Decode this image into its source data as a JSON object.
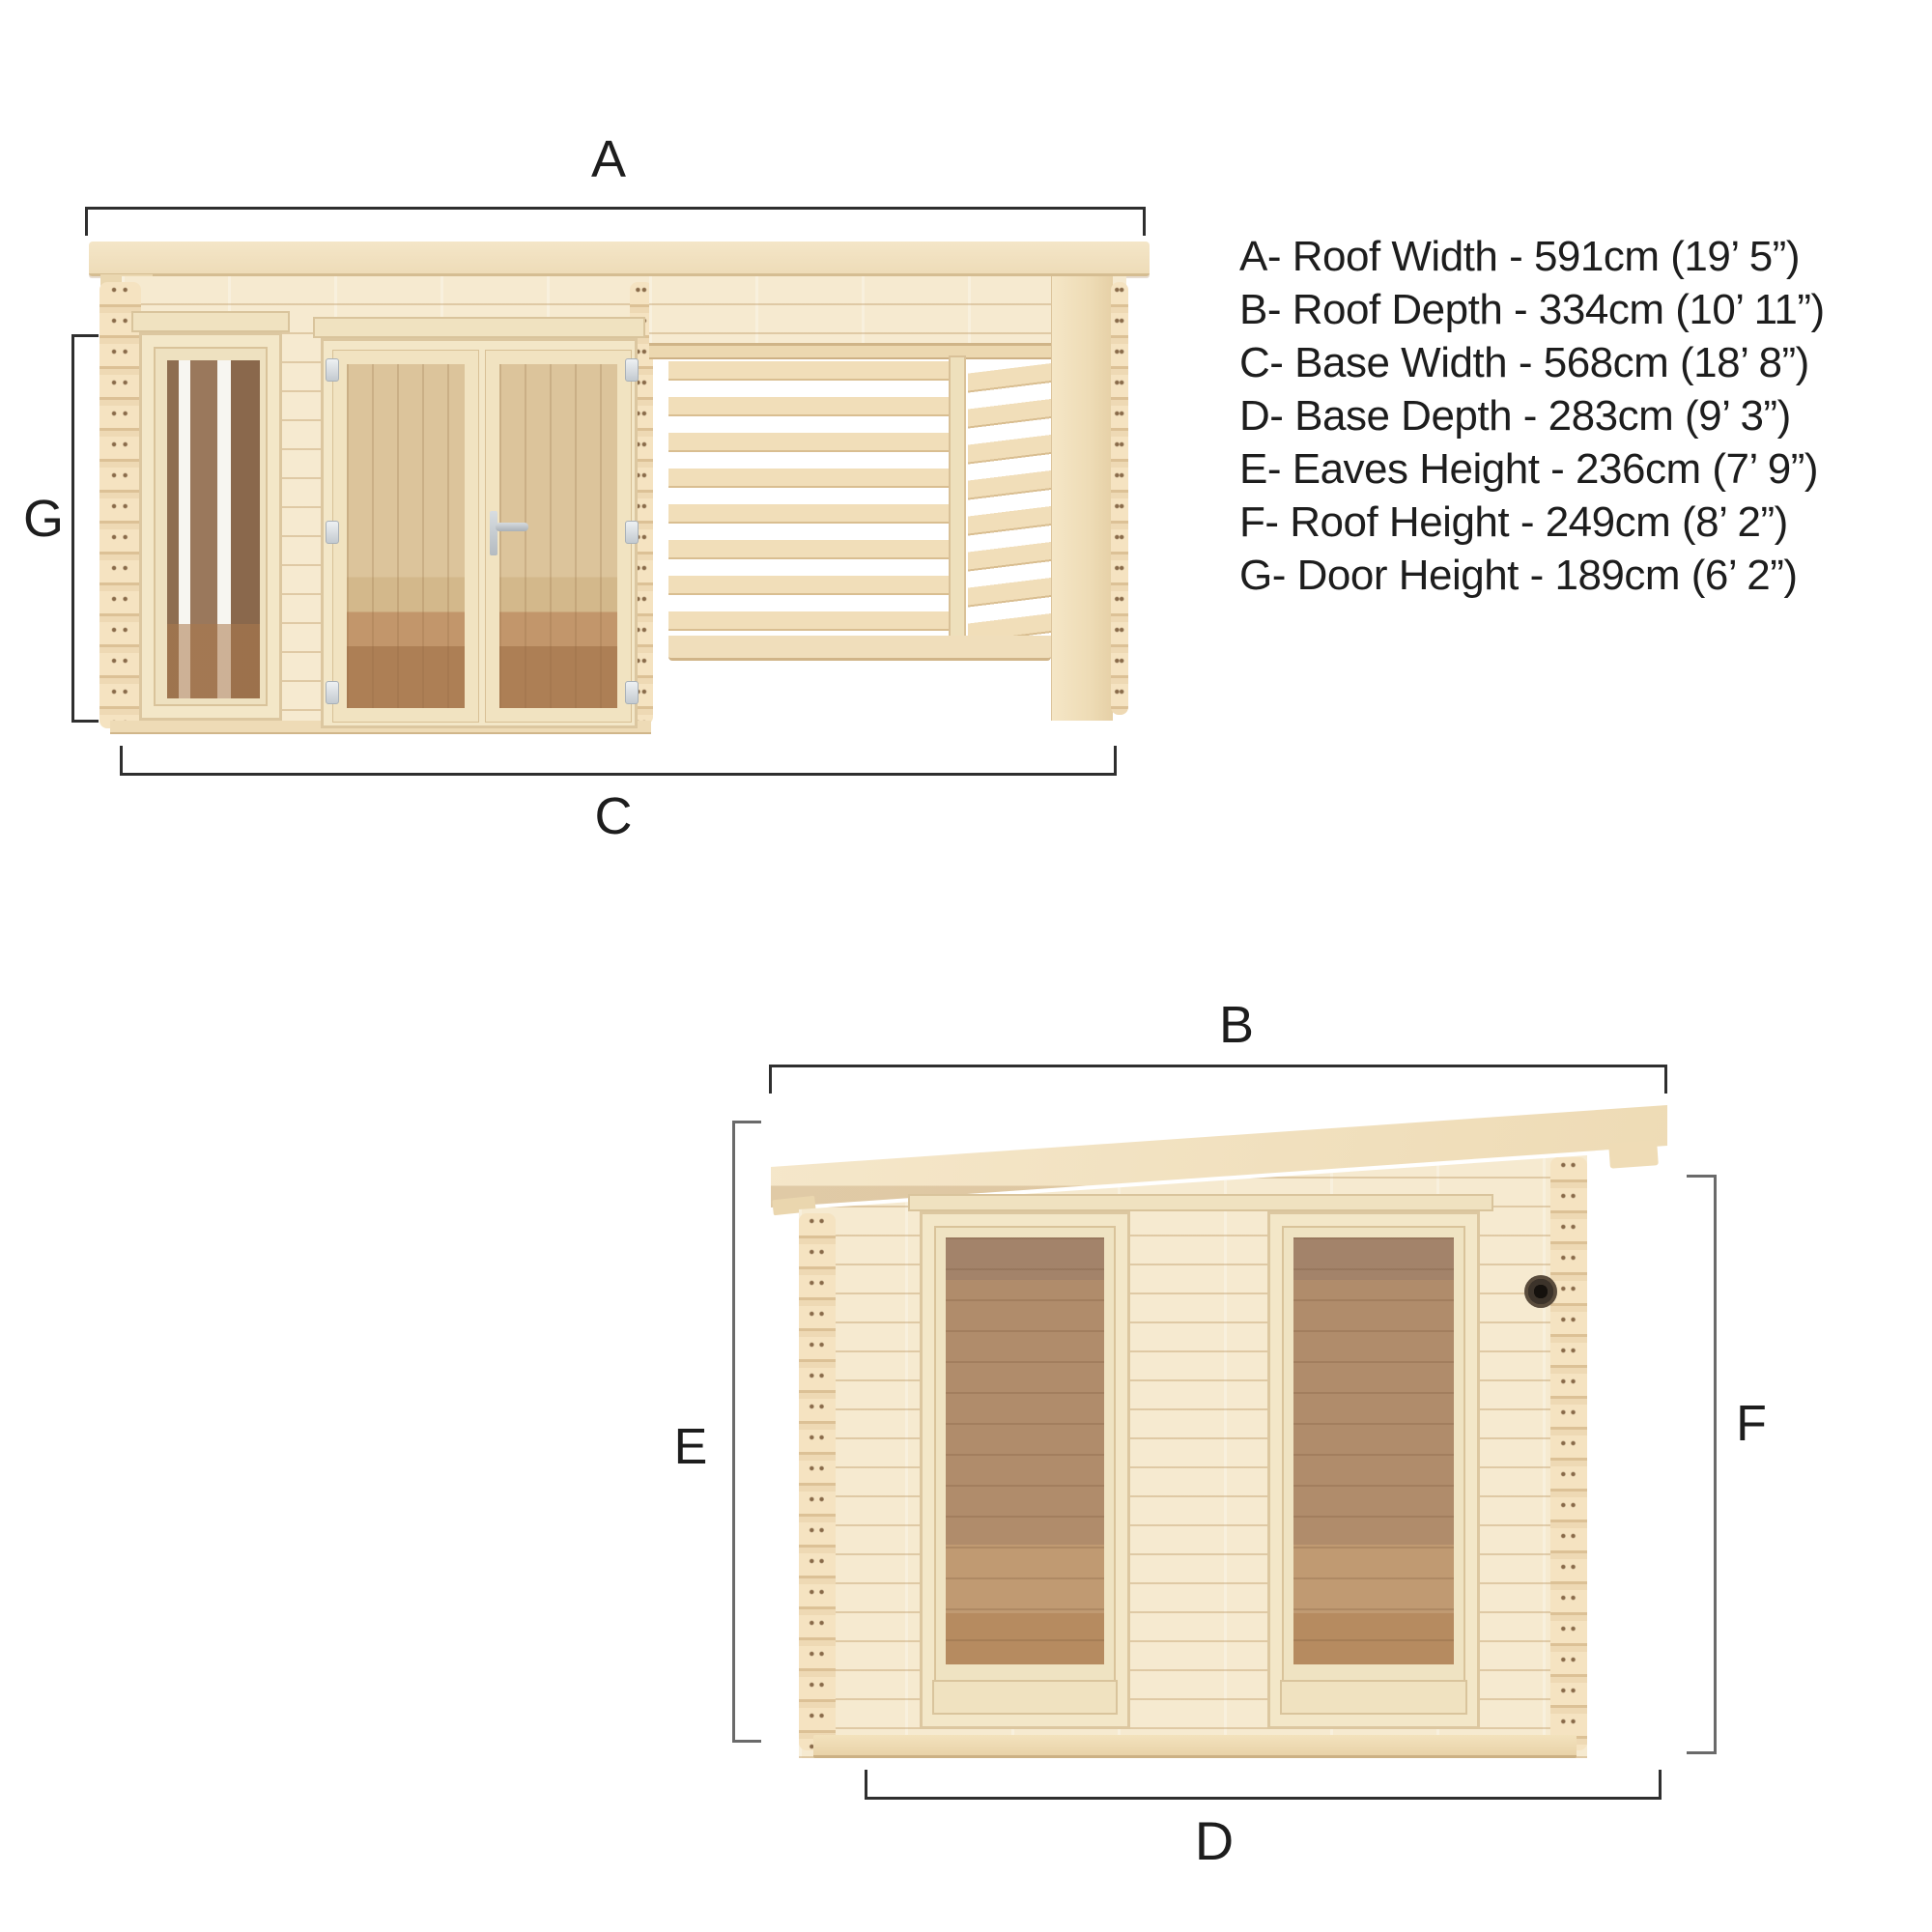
{
  "legend": {
    "lines": [
      {
        "text": "A- Roof Width - 591cm (19’ 5”)"
      },
      {
        "text": "B- Roof Depth - 334cm (10’ 11”)"
      },
      {
        "text": "C- Base Width - 568cm (18’ 8”)"
      },
      {
        "text": "D- Base Depth - 283cm (9’ 3”)"
      },
      {
        "text": "E- Eaves Height - 236cm (7’ 9”)"
      },
      {
        "text": "F- Roof Height - 249cm (8’ 2”)"
      },
      {
        "text": "G- Door Height - 189cm (6’ 2”)"
      }
    ]
  },
  "front_view": {
    "labels": {
      "roof_width": "A",
      "base_width": "C",
      "door_height": "G"
    }
  },
  "side_view": {
    "labels": {
      "roof_depth": "B",
      "base_depth": "D",
      "eaves_height": "E",
      "roof_height": "F"
    }
  },
  "colors": {
    "wood_light": "#f6ead0",
    "wood_mid": "#f0ddb8",
    "wood_edge": "#d8c096",
    "glass_brown": "#a8876a",
    "interior_tan": "#d9bd94",
    "floor_brown": "#b68a5e",
    "dim_line": "#2f2f2f",
    "dim_gray": "#6a6a6a",
    "text": "#1d1d1d"
  }
}
